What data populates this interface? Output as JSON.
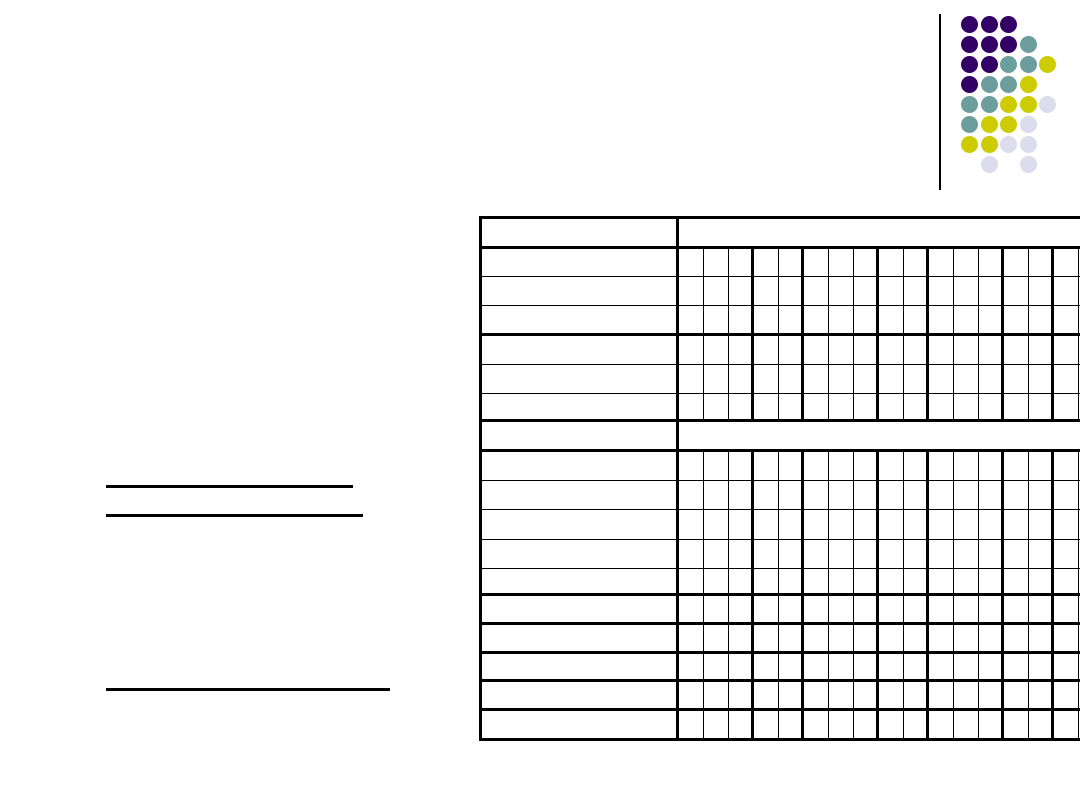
{
  "slide": {
    "background": "#ffffff",
    "width": 1080,
    "height": 810,
    "text_content": "none - all table cells and text lines are blank"
  },
  "decoration": {
    "divider_line": {
      "x": 939,
      "y": 14,
      "width": 2,
      "height": 176,
      "color": "#000000"
    },
    "dot_grid": {
      "x": 960,
      "y": 14,
      "cell_w": 19.5,
      "cell_h": 20,
      "dot_size": 17,
      "colors": {
        "P": "#330066",
        "T": "#6D9E9E",
        "Y": "#CCCC00",
        "L": "#DCDCEC"
      },
      "rows": [
        [
          "P",
          "P",
          "P",
          "",
          ""
        ],
        [
          "P",
          "P",
          "P",
          "T",
          ""
        ],
        [
          "P",
          "P",
          "T",
          "T",
          "Y"
        ],
        [
          "P",
          "T",
          "T",
          "Y",
          ""
        ],
        [
          "T",
          "T",
          "Y",
          "Y",
          "L"
        ],
        [
          "T",
          "Y",
          "Y",
          "L",
          ""
        ],
        [
          "Y",
          "Y",
          "L",
          "L",
          ""
        ],
        [
          "",
          "L",
          "",
          "L",
          ""
        ]
      ]
    }
  },
  "blank_lines": [
    {
      "x": 106,
      "y": 485,
      "width": 247,
      "height": 3
    },
    {
      "x": 106,
      "y": 514,
      "width": 257,
      "height": 3
    },
    {
      "x": 106,
      "y": 688,
      "width": 284,
      "height": 3
    }
  ],
  "table": {
    "x": 479,
    "y": 216,
    "content_width": 622,
    "border_color": "#000000",
    "outer_border_px": 3,
    "thick_px": 3,
    "thin_px": 1.5,
    "label_col_width": 197,
    "cell_width": 25,
    "cell_count": 17,
    "column_border_unit": [
      "thin",
      "thin",
      "thick",
      "thin",
      "thick"
    ],
    "rows": [
      {
        "kind": "header",
        "h": 30,
        "bb": "thick"
      },
      {
        "kind": "data",
        "h": 28,
        "bb": "thin"
      },
      {
        "kind": "data",
        "h": 29,
        "bb": "thin"
      },
      {
        "kind": "data",
        "h": 30,
        "bb": "thick"
      },
      {
        "kind": "data",
        "h": 29,
        "bb": "thin"
      },
      {
        "kind": "data",
        "h": 29,
        "bb": "thin"
      },
      {
        "kind": "data",
        "h": 28,
        "bb": "thick"
      },
      {
        "kind": "header",
        "h": 30,
        "bb": "thick"
      },
      {
        "kind": "data",
        "h": 29,
        "bb": "thin"
      },
      {
        "kind": "data",
        "h": 29,
        "bb": "thin"
      },
      {
        "kind": "data",
        "h": 30,
        "bb": "thin"
      },
      {
        "kind": "data",
        "h": 29,
        "bb": "thin"
      },
      {
        "kind": "data",
        "h": 27,
        "bb": "thick"
      },
      {
        "kind": "data",
        "h": 29,
        "bb": "thick"
      },
      {
        "kind": "data",
        "h": 29,
        "bb": "thick"
      },
      {
        "kind": "data",
        "h": 28,
        "bb": "thick"
      },
      {
        "kind": "data",
        "h": 29,
        "bb": "thick"
      },
      {
        "kind": "data",
        "h": 27,
        "bb": "none"
      }
    ],
    "cells_text": ""
  }
}
